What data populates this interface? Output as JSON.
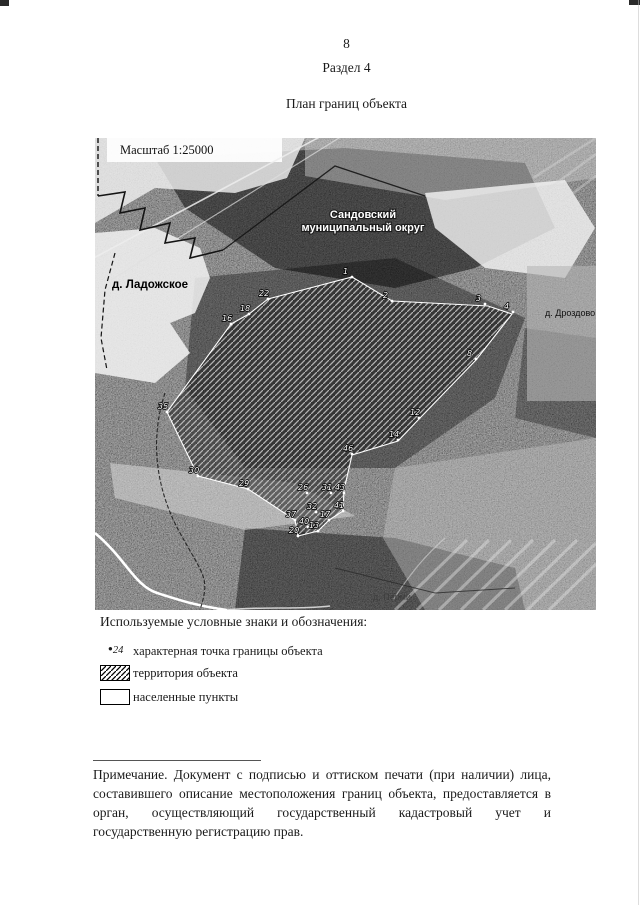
{
  "page": {
    "number": "8",
    "section": "Раздел 4",
    "title": "План границ объекта"
  },
  "map": {
    "scale_label": "Масштаб 1:25000",
    "labels": {
      "district_line1": "Сандовский",
      "district_line2": "муниципальный округ",
      "village_left": "д. Ладожское",
      "village_right": "д. Дроздово",
      "village_bottom": "д. Перми"
    },
    "points": [
      {
        "label": "1",
        "x": 257,
        "y": 139
      },
      {
        "label": "2",
        "x": 297,
        "y": 163
      },
      {
        "label": "3",
        "x": 390,
        "y": 166
      },
      {
        "label": "4",
        "x": 418,
        "y": 174
      },
      {
        "label": "8",
        "x": 381,
        "y": 221
      },
      {
        "label": "12",
        "x": 324,
        "y": 280
      },
      {
        "label": "14",
        "x": 303,
        "y": 302
      },
      {
        "label": "46",
        "x": 257,
        "y": 316
      },
      {
        "label": "43",
        "x": 249,
        "y": 355
      },
      {
        "label": "31",
        "x": 236,
        "y": 355
      },
      {
        "label": "26",
        "x": 212,
        "y": 355
      },
      {
        "label": "41",
        "x": 248,
        "y": 373
      },
      {
        "label": "32",
        "x": 221,
        "y": 374
      },
      {
        "label": "17",
        "x": 234,
        "y": 382
      },
      {
        "label": "37",
        "x": 200,
        "y": 382
      },
      {
        "label": "40",
        "x": 213,
        "y": 389
      },
      {
        "label": "13",
        "x": 223,
        "y": 393
      },
      {
        "label": "20",
        "x": 203,
        "y": 398
      },
      {
        "label": "29",
        "x": 153,
        "y": 351
      },
      {
        "label": "30",
        "x": 103,
        "y": 338
      },
      {
        "label": "35",
        "x": 72,
        "y": 274
      },
      {
        "label": "16",
        "x": 136,
        "y": 186
      },
      {
        "label": "18",
        "x": 154,
        "y": 176
      },
      {
        "label": "22",
        "x": 173,
        "y": 161
      }
    ]
  },
  "legend": {
    "heading": "Используемые условные знаки и обозначения:",
    "items": [
      {
        "marker": "24",
        "label": "характерная точка границы объекта"
      },
      {
        "label": "территория объекта"
      },
      {
        "label": "населенные пункты"
      }
    ]
  },
  "note": {
    "text": "Примечание. Документ с подписью и оттиском печати (при наличии) лица, составившего описание местоположения границ объекта, предоставляется в орган, осуществляющий государственный кадастровый учет и государственную регистрацию прав."
  },
  "colors": {
    "boundary_line": "#ffffff",
    "map_dark": "#1e1e1e",
    "map_light": "#e8e8e8"
  }
}
